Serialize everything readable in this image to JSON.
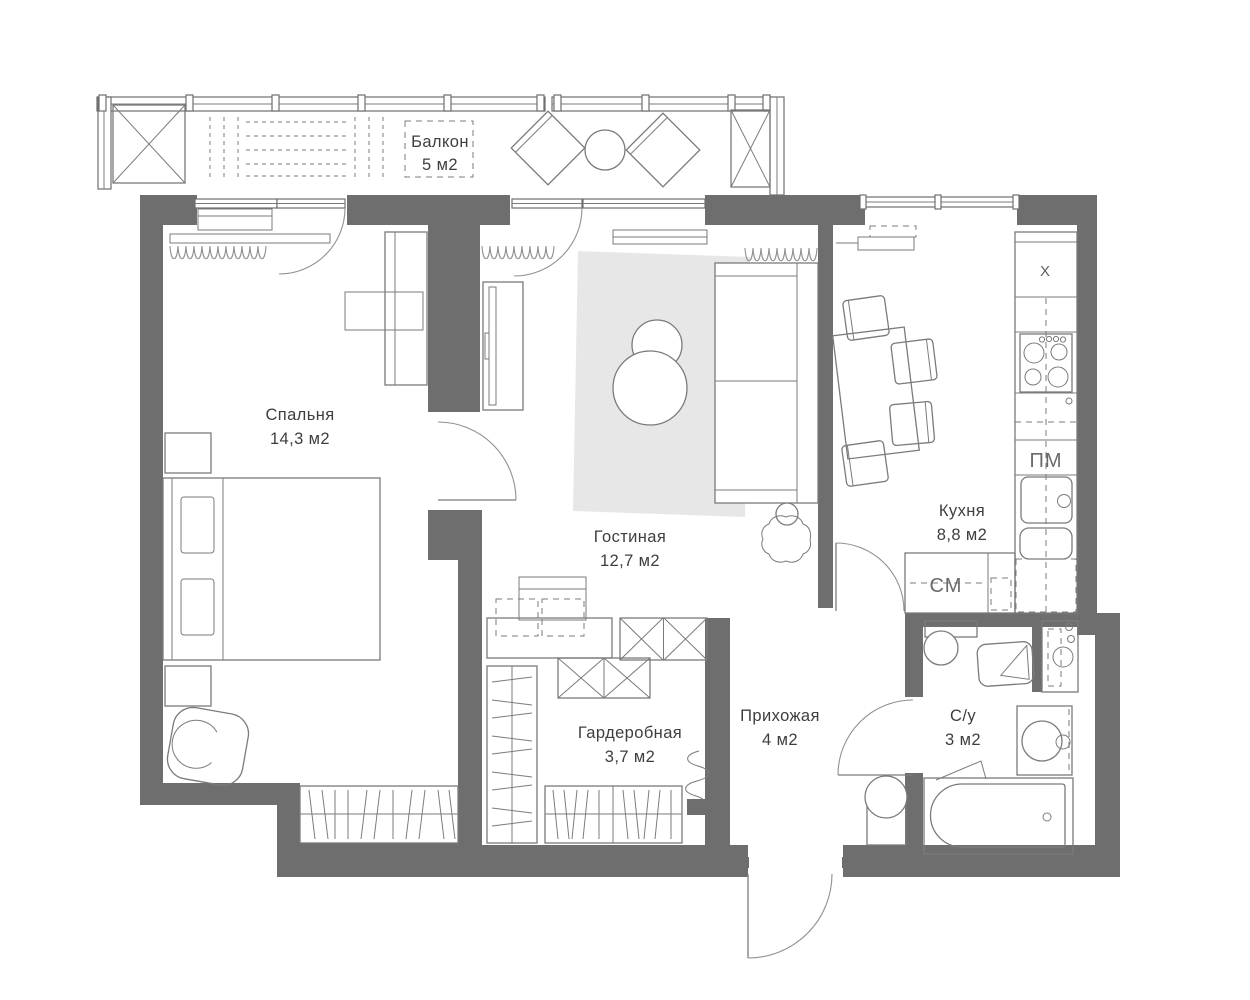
{
  "plan": {
    "rooms": {
      "balcony": {
        "name": "Балкон",
        "area": "5 м2"
      },
      "bedroom": {
        "name": "Спальня",
        "area": "14,3 м2"
      },
      "living_room": {
        "name": "Гостиная",
        "area": "12,7 м2"
      },
      "kitchen": {
        "name": "Кухня",
        "area": "8,8 м2"
      },
      "wardrobe": {
        "name": "Гардеробная",
        "area": "3,7 м2"
      },
      "hallway": {
        "name": "Прихожая",
        "area": "4 м2"
      },
      "bathroom": {
        "name": "С/у",
        "area": "3 м2"
      }
    },
    "appliance_labels": {
      "fridge": "X",
      "dishwasher": "ПМ",
      "washing_machine": "СМ"
    },
    "colors": {
      "walls": "#6e6e6e",
      "furniture_lines": "#7b7b7b",
      "rug": "#e7e7e7",
      "label_text": "#3e3e3e",
      "background": "#ffffff"
    }
  }
}
